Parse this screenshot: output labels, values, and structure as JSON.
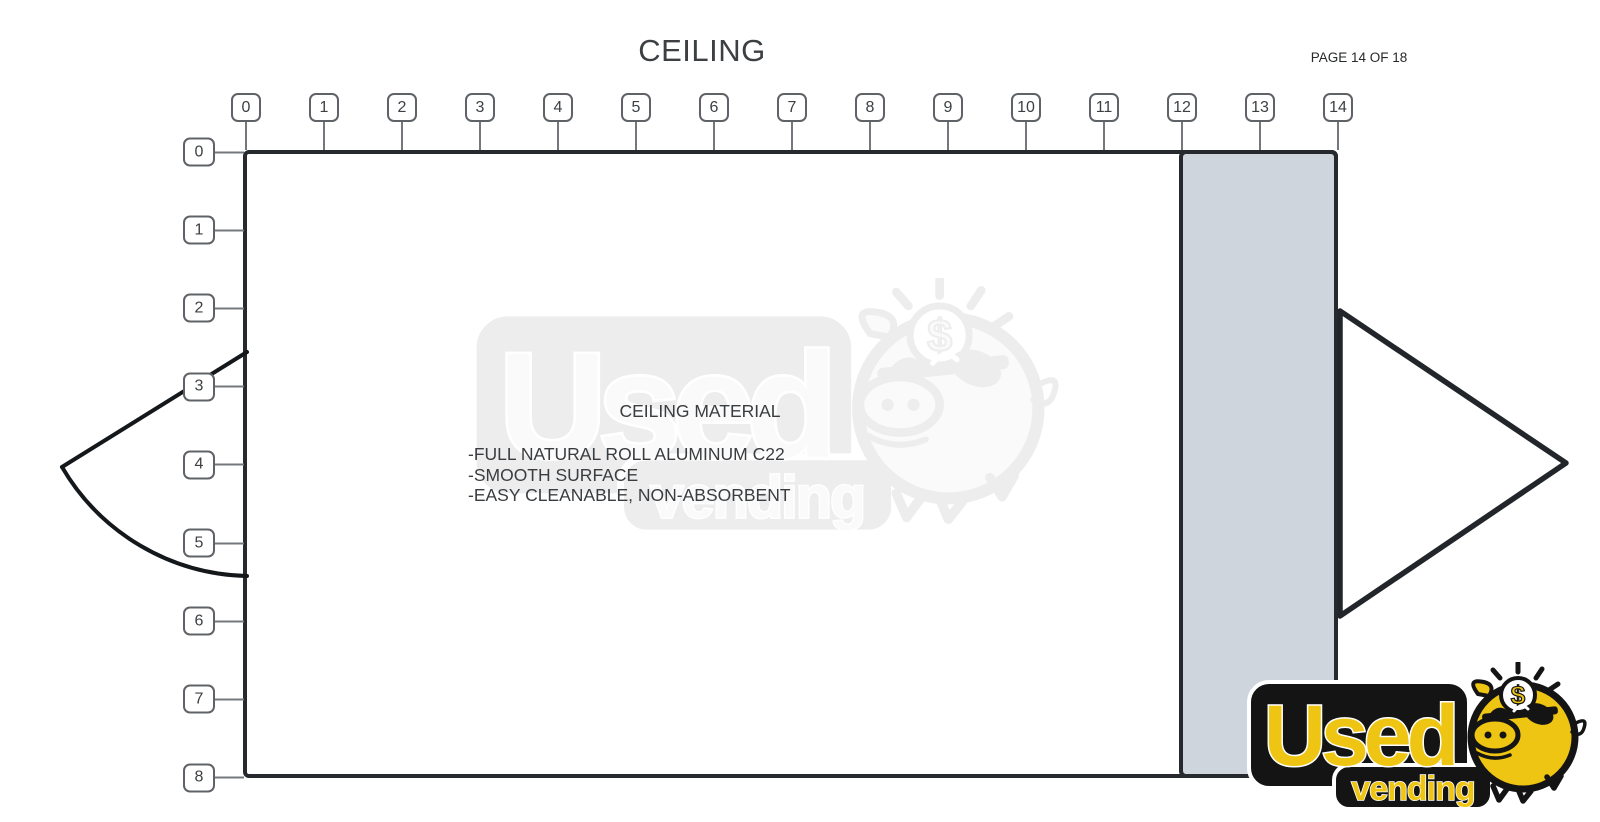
{
  "page": {
    "title": "CEILING",
    "page_indicator": "PAGE 14 OF 18"
  },
  "top_ruler": {
    "values": [
      "0",
      "1",
      "2",
      "3",
      "4",
      "5",
      "6",
      "7",
      "8",
      "9",
      "10",
      "11",
      "12",
      "13",
      "14"
    ]
  },
  "left_ruler": {
    "values": [
      "0",
      "1",
      "2",
      "3",
      "4",
      "5",
      "6",
      "7",
      "8"
    ]
  },
  "notes": {
    "heading": "CEILING MATERIAL",
    "items": [
      "-FULL NATURAL ROLL ALUMINUM C22",
      "-SMOOTH SURFACE",
      "-EASY CLEANABLE, NON-ABSORBENT"
    ]
  },
  "logo": {
    "word_top": "Used",
    "word_bottom": "vending",
    "coin_symbol": "$"
  },
  "colors": {
    "outline": "#26292d",
    "panel_fill": "#ced5dc",
    "ruler_border": "#5f6367",
    "ruler_text": "#3c4043",
    "tick": "#74787c",
    "text": "#3c4043",
    "brand_yellow": "#efc513",
    "brand_black": "#141414"
  }
}
